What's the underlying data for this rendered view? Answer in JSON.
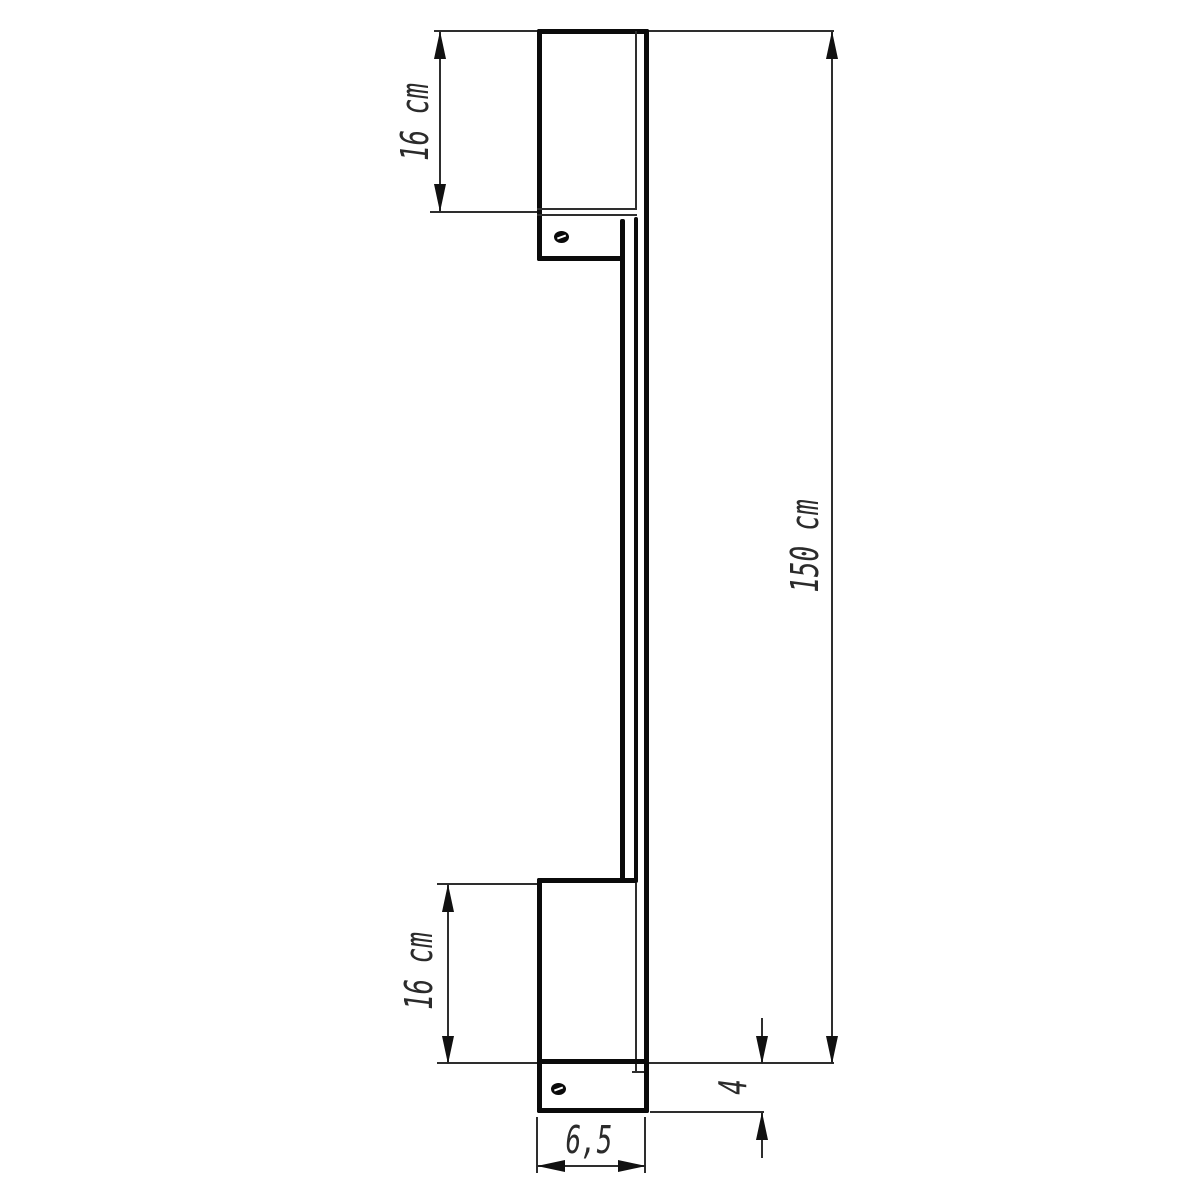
{
  "drawing": {
    "type": "technical-dimension-drawing",
    "subject": "vertical linear wall lamp, side view",
    "labels": {
      "top_section_height": "16 cm",
      "overall_length": "150 cm",
      "bottom_section_height": "16 cm",
      "bottom_offset_depth": "4",
      "body_width": "6,5"
    },
    "colors": {
      "outline": "#0b0b0b",
      "thin_line": "#2e2e2e",
      "text": "#2b2b2b",
      "background": "#ffffff"
    }
  }
}
